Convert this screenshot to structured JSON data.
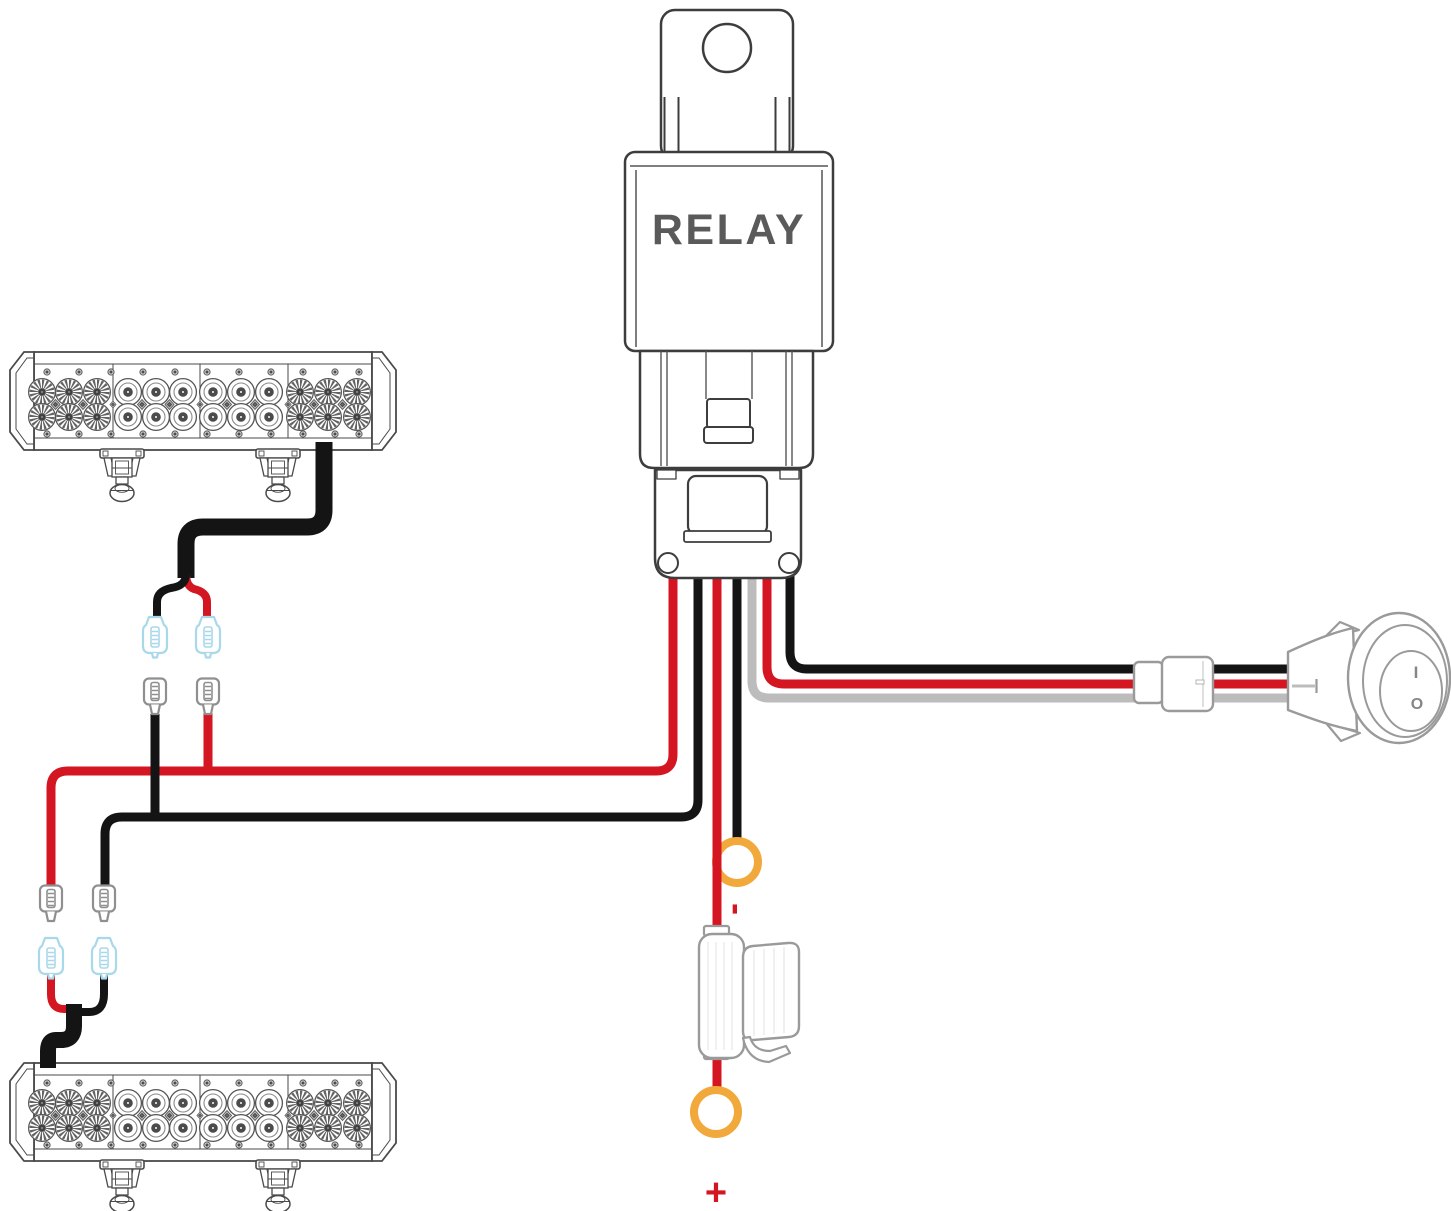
{
  "page": {
    "background": "#ffffff",
    "title": "LED light bar relay wiring harness diagram"
  },
  "relay": {
    "label": "RELAY"
  },
  "battery": {
    "negative_label": "-",
    "positive_label": "+"
  },
  "switch": {
    "on_label": "I",
    "off_label": "O"
  },
  "colors": {
    "wire_red": "#d41522",
    "wire_black": "#141414",
    "wire_gray": "#bcbcbc",
    "ring_terminal_orange": "#f2a93b",
    "connector_female_blue": "#a8d8ea",
    "connector_male_gray": "#8f8f8f",
    "outline_dark": "#3d3d3d",
    "outline_light": "#9a9a9a"
  },
  "components": [
    "relay with mounting tab",
    "relay socket connector",
    "top LED light bar",
    "bottom LED light bar",
    "inline fuse holder",
    "negative ring terminal",
    "positive ring terminal",
    "rocker switch",
    "switch inline connector",
    "quick-connect spade terminals (female blue, male gray)"
  ],
  "wires": [
    {
      "color": "red",
      "from": "relay",
      "to": "top LED light bar (via quick connects)"
    },
    {
      "color": "black",
      "from": "relay",
      "to": "top LED light bar (via quick connects)"
    },
    {
      "color": "red",
      "from": "relay",
      "to": "bottom LED light bar (via quick connects)"
    },
    {
      "color": "black",
      "from": "relay",
      "to": "bottom LED light bar (via quick connects)"
    },
    {
      "color": "red",
      "from": "relay",
      "to": "fuse holder then battery positive ring terminal"
    },
    {
      "color": "black",
      "from": "relay",
      "to": "battery negative ring terminal"
    },
    {
      "color": "black",
      "from": "relay",
      "to": "rocker switch"
    },
    {
      "color": "red",
      "from": "relay",
      "to": "rocker switch"
    },
    {
      "color": "gray",
      "from": "relay",
      "to": "rocker switch"
    }
  ]
}
